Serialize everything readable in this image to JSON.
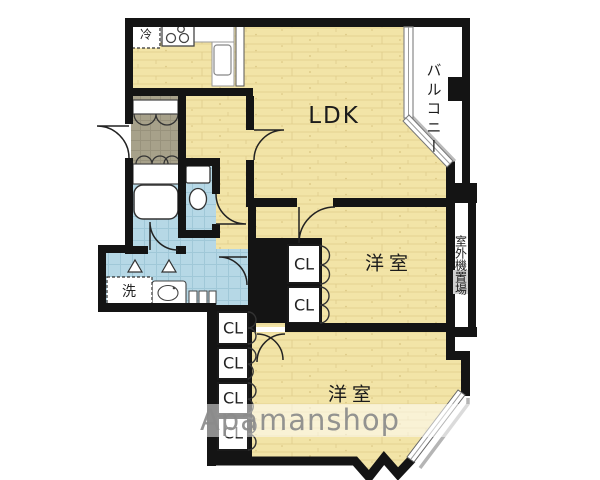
{
  "labels": {
    "ldk": "LDK",
    "bedroom_mid": "洋室",
    "bedroom_low": "洋室",
    "balcony": "バルコニー",
    "outdoor_unit": "室外機置場",
    "fridge": "冷",
    "washer": "洗",
    "closets_mid": [
      "CL",
      "CL"
    ],
    "closets_low": [
      "CL",
      "CL",
      "CL",
      "CL"
    ]
  },
  "watermark": "Apamanshop",
  "colors": {
    "wall": "#141414",
    "wood_floor": "#f2e4a7",
    "wet_area_tile": "#b6d8e6",
    "entry_tile": "#a7a18a",
    "watermark_text": "#8b8b8b",
    "window_frame": "#777777"
  }
}
